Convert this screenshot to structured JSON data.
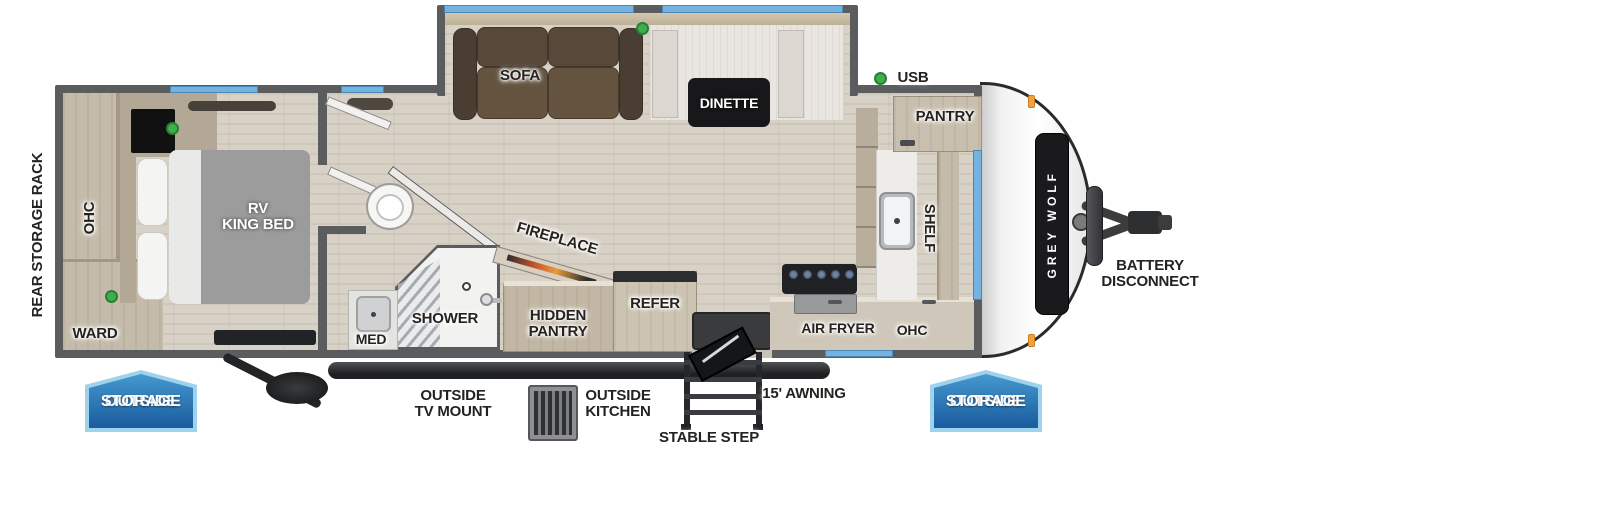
{
  "labels": {
    "rear_storage_rack": "REAR STORAGE RACK",
    "ohc_bedroom": "OHC",
    "ward": "WARD",
    "bed_line1": "RV",
    "bed_line2": "KING BED",
    "med": "MED",
    "shower": "SHOWER",
    "sofa": "SOFA",
    "dinette": "DINETTE",
    "fireplace": "FIREPLACE",
    "hidden_pantry_line1": "HIDDEN",
    "hidden_pantry_line2": "PANTRY",
    "refer": "REFER",
    "usb": "USB",
    "pantry": "PANTRY",
    "shelf": "SHELF",
    "air_fryer": "AIR FRYER",
    "ohc_kitchen": "OHC",
    "outside_storage_line1": "OUTSIDE",
    "outside_storage_line2": "STORAGE",
    "outside_tv_mount_line1": "OUTSIDE",
    "outside_tv_mount_line2": "TV MOUNT",
    "outside_kitchen_line1": "OUTSIDE",
    "outside_kitchen_line2": "KITCHEN",
    "stable_step": "STABLE STEP",
    "awning": "15' AWNING",
    "battery_line1": "BATTERY",
    "battery_line2": "DISCONNECT",
    "brand": "GREY WOLF"
  },
  "colors": {
    "wall_gray": "#5b5c5e",
    "floor_wood": "#d8d1c6",
    "cabinet_wood": "#c5bbab",
    "window_blue": "#74b2e2",
    "badge_blue_top": "#4598cf",
    "badge_blue_bottom": "#1a5c9e",
    "badge_border": "#9fd2ec",
    "usb_green": "#3faf4b",
    "marker_orange": "#f2a13b"
  }
}
